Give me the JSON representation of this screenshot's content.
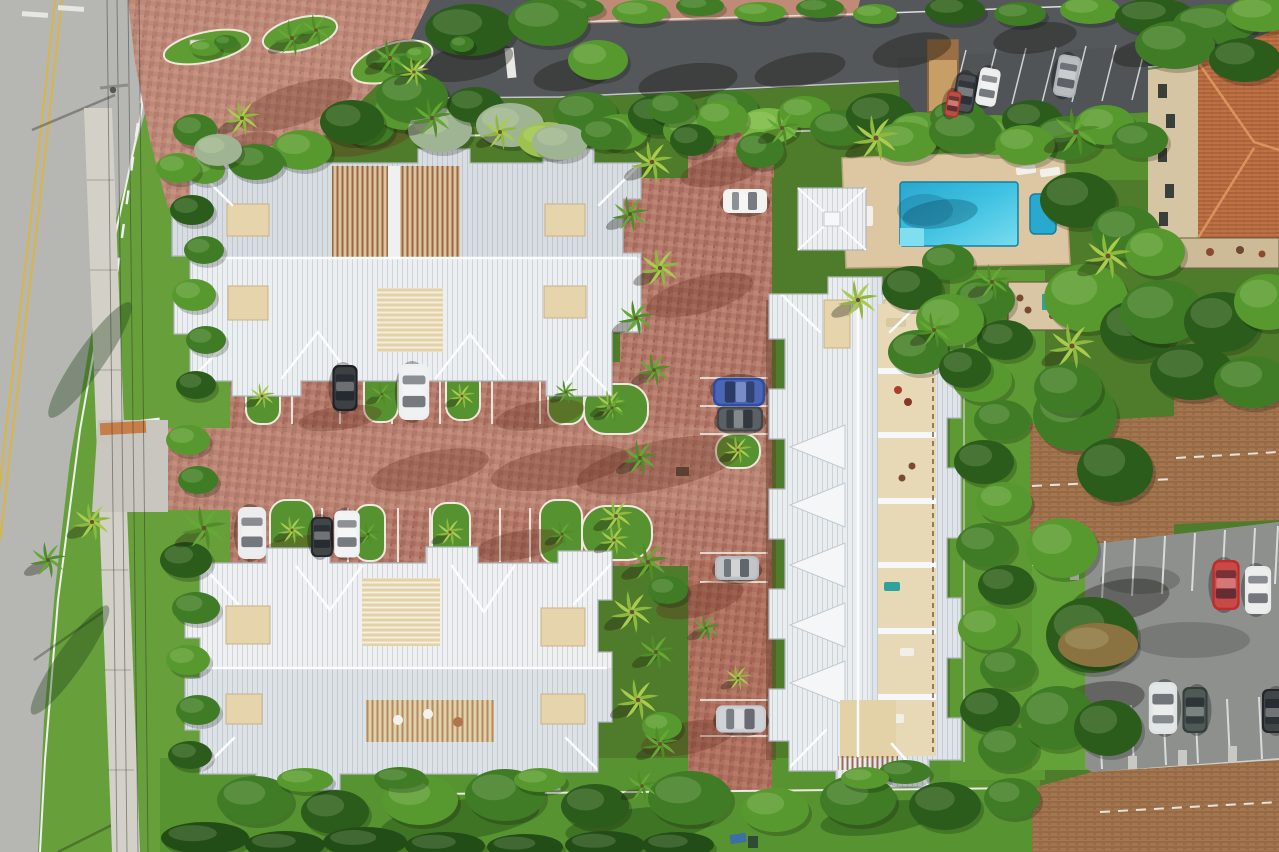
{
  "meta": {
    "type": "aerial-photograph",
    "description": "Top-down drone aerial photo of a tropical residential community: three large townhome buildings with white standing-seam metal roofs and open rooftop courtyards around a red brick driveway lined with palm trees; swimming pool with tan deck and cabana at top right; public road with yellow and white lane markings at left; dark asphalt street and angled parking at top; neighboring terracotta tile roof building at top right and brown shingle roof apartment buildings with a striped parking lot at bottom right; dense green tropical landscaping throughout."
  },
  "palette": {
    "base_vegetation": "#4f7c2a",
    "lawn_bright": "#679f3b",
    "lawn_mid": "#579431",
    "road_concrete": "#b6b7b3",
    "street_asphalt": "#54585a",
    "lot_asphalt_dark": "#505456",
    "lot_asphalt_light": "#8e908e",
    "sidewalk": "#d3d0c8",
    "brick": "#b3796a",
    "brick_light": "#c08b76",
    "roof_white": "#eceff1",
    "roof_shade": "#d8dde2",
    "ridge_white": "#fbfcfd",
    "courtyard_tan": "#e6d4ad",
    "pergola_brown": "#8a4f33",
    "pool_water": "#2eb4da",
    "spa_water": "#2aa9cf",
    "pool_deck": "#dcc7a2",
    "terracotta_roof": "#bd7345",
    "stucco_beige": "#d6c5a2",
    "brown_shingle": "#a3764f",
    "lane_yellow": "#d9b544",
    "marking_white": "#eef0ee",
    "tree_colors": [
      "#2b5c1c",
      "#3f7c25",
      "#58992f",
      "#79b844",
      "#9fb492",
      "#234d17",
      "#8a7340",
      "#9dc24f"
    ],
    "shadow_colors": [
      "rgba(15,14,10,0.33)",
      "rgba(95,44,28,0.30)",
      "rgba(8,58,82,0.30)",
      "rgba(22,58,18,0.35)"
    ]
  },
  "scene": {
    "counts": {
      "white_roof_buildings": 3,
      "pool": 1,
      "spa": 1,
      "cabana": 1,
      "cars_visible": 19
    },
    "shadows": [
      [
        468,
        62,
        46,
        18,
        -12,
        0
      ],
      [
        575,
        74,
        42,
        16,
        -10,
        0
      ],
      [
        688,
        82,
        50,
        18,
        -8,
        0
      ],
      [
        800,
        70,
        46,
        16,
        -10,
        0
      ],
      [
        912,
        50,
        40,
        16,
        -12,
        0
      ],
      [
        1035,
        38,
        42,
        15,
        -8,
        0
      ],
      [
        1150,
        52,
        38,
        14,
        -10,
        0
      ],
      [
        395,
        55,
        30,
        14,
        -15,
        0
      ],
      [
        295,
        105,
        60,
        20,
        -18,
        1
      ],
      [
        370,
        135,
        52,
        18,
        -15,
        1
      ],
      [
        240,
        152,
        40,
        16,
        -20,
        1
      ],
      [
        700,
        295,
        55,
        18,
        -15,
        1
      ],
      [
        660,
        465,
        85,
        24,
        -12,
        1
      ],
      [
        560,
        468,
        70,
        20,
        -10,
        1
      ],
      [
        430,
        470,
        60,
        18,
        -12,
        1
      ],
      [
        700,
        600,
        45,
        16,
        -15,
        1
      ],
      [
        688,
        738,
        48,
        16,
        -12,
        1
      ],
      [
        720,
        172,
        40,
        14,
        -10,
        1
      ],
      [
        540,
        415,
        45,
        14,
        -10,
        1
      ],
      [
        520,
        545,
        45,
        14,
        -10,
        1
      ],
      [
        340,
        418,
        42,
        12,
        -8,
        1
      ],
      [
        300,
        548,
        40,
        12,
        -8,
        1
      ],
      [
        940,
        214,
        38,
        14,
        -8,
        2
      ],
      [
        460,
        820,
        80,
        20,
        -8,
        3
      ],
      [
        640,
        826,
        75,
        18,
        -6,
        3
      ],
      [
        880,
        818,
        60,
        16,
        -8,
        3
      ],
      [
        90,
        360,
        70,
        14,
        -55,
        3
      ],
      [
        70,
        660,
        66,
        13,
        -55,
        3
      ],
      [
        1120,
        600,
        50,
        20,
        -10,
        0
      ],
      [
        1100,
        700,
        45,
        18,
        -8,
        0
      ]
    ],
    "trees": [
      [
        368,
        128,
        26,
        18,
        1
      ],
      [
        405,
        110,
        30,
        20,
        2
      ],
      [
        440,
        130,
        32,
        22,
        4
      ],
      [
        475,
        105,
        28,
        18,
        0
      ],
      [
        510,
        125,
        34,
        22,
        4
      ],
      [
        548,
        140,
        30,
        18,
        7
      ],
      [
        585,
        112,
        32,
        20,
        1
      ],
      [
        620,
        132,
        28,
        18,
        2
      ],
      [
        658,
        115,
        30,
        20,
        0
      ],
      [
        695,
        130,
        32,
        20,
        2
      ],
      [
        730,
        108,
        28,
        18,
        1
      ],
      [
        768,
        126,
        30,
        18,
        3
      ],
      [
        805,
        112,
        26,
        16,
        2
      ],
      [
        840,
        128,
        30,
        18,
        1
      ],
      [
        880,
        115,
        34,
        22,
        0
      ],
      [
        920,
        130,
        30,
        18,
        2
      ],
      [
        958,
        118,
        28,
        18,
        1
      ],
      [
        995,
        135,
        32,
        20,
        2
      ],
      [
        1032,
        120,
        30,
        20,
        0
      ],
      [
        1068,
        138,
        34,
        22,
        1
      ],
      [
        1105,
        125,
        30,
        20,
        2
      ],
      [
        1140,
        140,
        28,
        18,
        1
      ],
      [
        580,
        8,
        24,
        10,
        1
      ],
      [
        640,
        12,
        28,
        12,
        2
      ],
      [
        700,
        6,
        24,
        10,
        1
      ],
      [
        760,
        12,
        26,
        10,
        2
      ],
      [
        820,
        8,
        24,
        10,
        1
      ],
      [
        875,
        14,
        22,
        10,
        2
      ],
      [
        955,
        10,
        30,
        14,
        0
      ],
      [
        1020,
        14,
        26,
        12,
        1
      ],
      [
        1090,
        10,
        30,
        14,
        2
      ],
      [
        1155,
        16,
        40,
        18,
        0
      ],
      [
        1215,
        24,
        42,
        20,
        1
      ],
      [
        1262,
        14,
        36,
        18,
        2
      ],
      [
        470,
        30,
        45,
        26,
        0
      ],
      [
        548,
        22,
        40,
        24,
        1
      ],
      [
        598,
        60,
        30,
        20,
        2
      ],
      [
        1175,
        45,
        40,
        24,
        1
      ],
      [
        1245,
        60,
        36,
        22,
        0
      ],
      [
        195,
        130,
        22,
        16,
        1
      ],
      [
        205,
        170,
        20,
        14,
        2
      ],
      [
        192,
        210,
        22,
        15,
        0
      ],
      [
        204,
        250,
        20,
        14,
        1
      ],
      [
        194,
        295,
        22,
        16,
        2
      ],
      [
        206,
        340,
        20,
        14,
        1
      ],
      [
        196,
        385,
        20,
        14,
        0
      ],
      [
        188,
        440,
        22,
        15,
        2
      ],
      [
        198,
        480,
        20,
        14,
        1
      ],
      [
        186,
        560,
        26,
        18,
        0
      ],
      [
        196,
        608,
        24,
        16,
        1
      ],
      [
        188,
        660,
        22,
        15,
        2
      ],
      [
        198,
        710,
        22,
        15,
        1
      ],
      [
        190,
        755,
        22,
        14,
        0
      ],
      [
        985,
        300,
        30,
        22,
        1
      ],
      [
        1005,
        340,
        28,
        20,
        0
      ],
      [
        982,
        380,
        30,
        22,
        2
      ],
      [
        1002,
        420,
        28,
        20,
        1
      ],
      [
        984,
        462,
        30,
        22,
        0
      ],
      [
        1004,
        502,
        28,
        20,
        2
      ],
      [
        986,
        545,
        30,
        22,
        1
      ],
      [
        1006,
        585,
        28,
        20,
        0
      ],
      [
        988,
        628,
        30,
        22,
        2
      ],
      [
        1008,
        668,
        28,
        20,
        1
      ],
      [
        990,
        710,
        30,
        22,
        0
      ],
      [
        1008,
        748,
        30,
        22,
        1
      ],
      [
        1075,
        415,
        42,
        36,
        1
      ],
      [
        1115,
        470,
        38,
        32,
        0
      ],
      [
        1062,
        548,
        36,
        30,
        2
      ],
      [
        1092,
        635,
        46,
        38,
        0
      ],
      [
        1058,
        718,
        38,
        32,
        1
      ],
      [
        1108,
        728,
        34,
        28,
        0
      ],
      [
        1098,
        645,
        40,
        22,
        6
      ],
      [
        1078,
        200,
        38,
        28,
        0
      ],
      [
        1126,
        232,
        34,
        26,
        1
      ],
      [
        1086,
        298,
        42,
        34,
        2
      ],
      [
        1138,
        330,
        38,
        30,
        0
      ],
      [
        1068,
        388,
        34,
        26,
        1
      ],
      [
        1162,
        312,
        42,
        32,
        1
      ],
      [
        1222,
        322,
        38,
        30,
        0
      ],
      [
        1268,
        302,
        34,
        28,
        2
      ],
      [
        1192,
        372,
        42,
        28,
        0
      ],
      [
        1252,
        382,
        38,
        26,
        1
      ],
      [
        1155,
        252,
        30,
        24,
        2
      ],
      [
        905,
        142,
        32,
        20,
        2
      ],
      [
        965,
        132,
        36,
        22,
        1
      ],
      [
        1025,
        145,
        30,
        20,
        2
      ],
      [
        760,
        150,
        24,
        18,
        1
      ],
      [
        722,
        118,
        26,
        18,
        2
      ],
      [
        692,
        140,
        22,
        16,
        0
      ],
      [
        672,
        108,
        24,
        16,
        1
      ],
      [
        948,
        262,
        26,
        18,
        1
      ],
      [
        912,
        288,
        30,
        22,
        0
      ],
      [
        950,
        320,
        34,
        26,
        2
      ],
      [
        918,
        352,
        30,
        22,
        1
      ],
      [
        965,
        368,
        26,
        20,
        0
      ],
      [
        255,
        800,
        38,
        24,
        1
      ],
      [
        335,
        812,
        34,
        22,
        0
      ],
      [
        420,
        800,
        38,
        25,
        2
      ],
      [
        505,
        795,
        40,
        26,
        1
      ],
      [
        595,
        806,
        34,
        22,
        0
      ],
      [
        690,
        798,
        42,
        27,
        1
      ],
      [
        775,
        810,
        34,
        22,
        2
      ],
      [
        858,
        800,
        38,
        25,
        1
      ],
      [
        945,
        806,
        36,
        24,
        0
      ],
      [
        1012,
        798,
        28,
        20,
        1
      ],
      [
        205,
        838,
        44,
        16,
        5
      ],
      [
        285,
        845,
        40,
        14,
        5
      ],
      [
        365,
        842,
        42,
        15,
        5
      ],
      [
        445,
        846,
        40,
        14,
        5
      ],
      [
        525,
        847,
        38,
        13,
        5
      ],
      [
        605,
        845,
        40,
        14,
        5
      ],
      [
        678,
        845,
        36,
        13,
        5
      ],
      [
        305,
        780,
        28,
        12,
        2
      ],
      [
        400,
        778,
        26,
        11,
        1
      ],
      [
        540,
        780,
        26,
        12,
        2
      ],
      [
        905,
        772,
        26,
        12,
        1
      ],
      [
        865,
        778,
        24,
        11,
        2
      ],
      [
        668,
        590,
        20,
        14,
        1
      ],
      [
        662,
        726,
        20,
        14,
        2
      ],
      [
        412,
        96,
        36,
        24,
        1
      ],
      [
        352,
        122,
        32,
        22,
        0
      ],
      [
        302,
        150,
        30,
        20,
        2
      ],
      [
        256,
        162,
        28,
        18,
        1
      ],
      [
        218,
        150,
        24,
        16,
        4
      ],
      [
        178,
        168,
        22,
        15,
        2
      ],
      [
        560,
        142,
        28,
        18,
        4
      ],
      [
        605,
        134,
        24,
        16,
        1
      ],
      [
        205,
        48,
        16,
        8,
        2
      ],
      [
        226,
        42,
        12,
        7,
        1
      ],
      [
        395,
        62,
        18,
        9,
        1
      ],
      [
        418,
        54,
        12,
        7,
        2
      ],
      [
        462,
        44,
        12,
        8,
        1
      ]
    ],
    "palms": [
      [
        652,
        162,
        1.05,
        1
      ],
      [
        630,
        214,
        0.9,
        0
      ],
      [
        660,
        268,
        1,
        1
      ],
      [
        636,
        318,
        0.9,
        0
      ],
      [
        654,
        370,
        0.85,
        0
      ],
      [
        610,
        404,
        0.75,
        1
      ],
      [
        640,
        458,
        0.9,
        0
      ],
      [
        616,
        516,
        0.85,
        1
      ],
      [
        648,
        562,
        1,
        0
      ],
      [
        632,
        612,
        1.05,
        1
      ],
      [
        656,
        652,
        0.9,
        0
      ],
      [
        638,
        700,
        1.05,
        1
      ],
      [
        660,
        744,
        0.9,
        0
      ],
      [
        642,
        786,
        0.8,
        0
      ],
      [
        262,
        396,
        0.65,
        1
      ],
      [
        382,
        394,
        0.6,
        0
      ],
      [
        462,
        396,
        0.65,
        1
      ],
      [
        566,
        392,
        0.6,
        0
      ],
      [
        292,
        530,
        0.7,
        1
      ],
      [
        368,
        534,
        0.6,
        0
      ],
      [
        450,
        532,
        0.7,
        1
      ],
      [
        562,
        534,
        0.65,
        0
      ],
      [
        612,
        408,
        0.7,
        0
      ],
      [
        614,
        540,
        0.75,
        1
      ],
      [
        738,
        450,
        0.7,
        1
      ],
      [
        706,
        628,
        0.7,
        0
      ],
      [
        738,
        678,
        0.65,
        1
      ],
      [
        876,
        138,
        1.15,
        1
      ],
      [
        1076,
        132,
        1.2,
        0
      ],
      [
        858,
        300,
        1,
        1
      ],
      [
        1072,
        346,
        1.15,
        1
      ],
      [
        934,
        330,
        0.9,
        0
      ],
      [
        1108,
        256,
        1.15,
        1
      ],
      [
        204,
        528,
        1.1,
        0
      ],
      [
        92,
        522,
        0.95,
        1
      ],
      [
        48,
        560,
        0.9,
        0
      ],
      [
        292,
        38,
        0.9,
        0
      ],
      [
        316,
        30,
        0.8,
        0
      ],
      [
        390,
        58,
        0.95,
        0
      ],
      [
        414,
        72,
        0.75,
        1
      ],
      [
        242,
        118,
        0.9,
        1
      ],
      [
        432,
        118,
        1,
        0
      ],
      [
        500,
        132,
        0.9,
        1
      ],
      [
        782,
        128,
        0.9,
        0
      ],
      [
        992,
        282,
        0.9,
        0
      ]
    ],
    "cars": [
      [
        745,
        201,
        0,
        44,
        "#f1f2f0"
      ],
      [
        739,
        392,
        180,
        52,
        "#2e4da8"
      ],
      [
        740,
        419,
        0,
        46,
        "#41464b"
      ],
      [
        737,
        568,
        0,
        44,
        "#b9bcbe"
      ],
      [
        741,
        719,
        0,
        50,
        "#c9ccce"
      ],
      [
        345,
        388,
        90,
        46,
        "#1e2226"
      ],
      [
        414,
        392,
        90,
        56,
        "#edeff0"
      ],
      [
        252,
        533,
        90,
        52,
        "#e9ebec"
      ],
      [
        322,
        537,
        90,
        40,
        "#24282c"
      ],
      [
        347,
        534,
        90,
        47,
        "#f0f2f2"
      ],
      [
        965,
        93,
        100,
        40,
        "#2f343a"
      ],
      [
        988,
        87,
        100,
        38,
        "#eaeceb"
      ],
      [
        1067,
        76,
        100,
        42,
        "#aeb3b6"
      ],
      [
        953,
        104,
        100,
        26,
        "#b03027"
      ],
      [
        1226,
        585,
        90,
        50,
        "#c02b2b"
      ],
      [
        1258,
        590,
        90,
        48,
        "#e9ebeb"
      ],
      [
        1163,
        708,
        270,
        52,
        "#e0e3e3"
      ],
      [
        1195,
        710,
        270,
        46,
        "#333f3b"
      ],
      [
        1274,
        711,
        270,
        44,
        "#23272b"
      ]
    ]
  }
}
